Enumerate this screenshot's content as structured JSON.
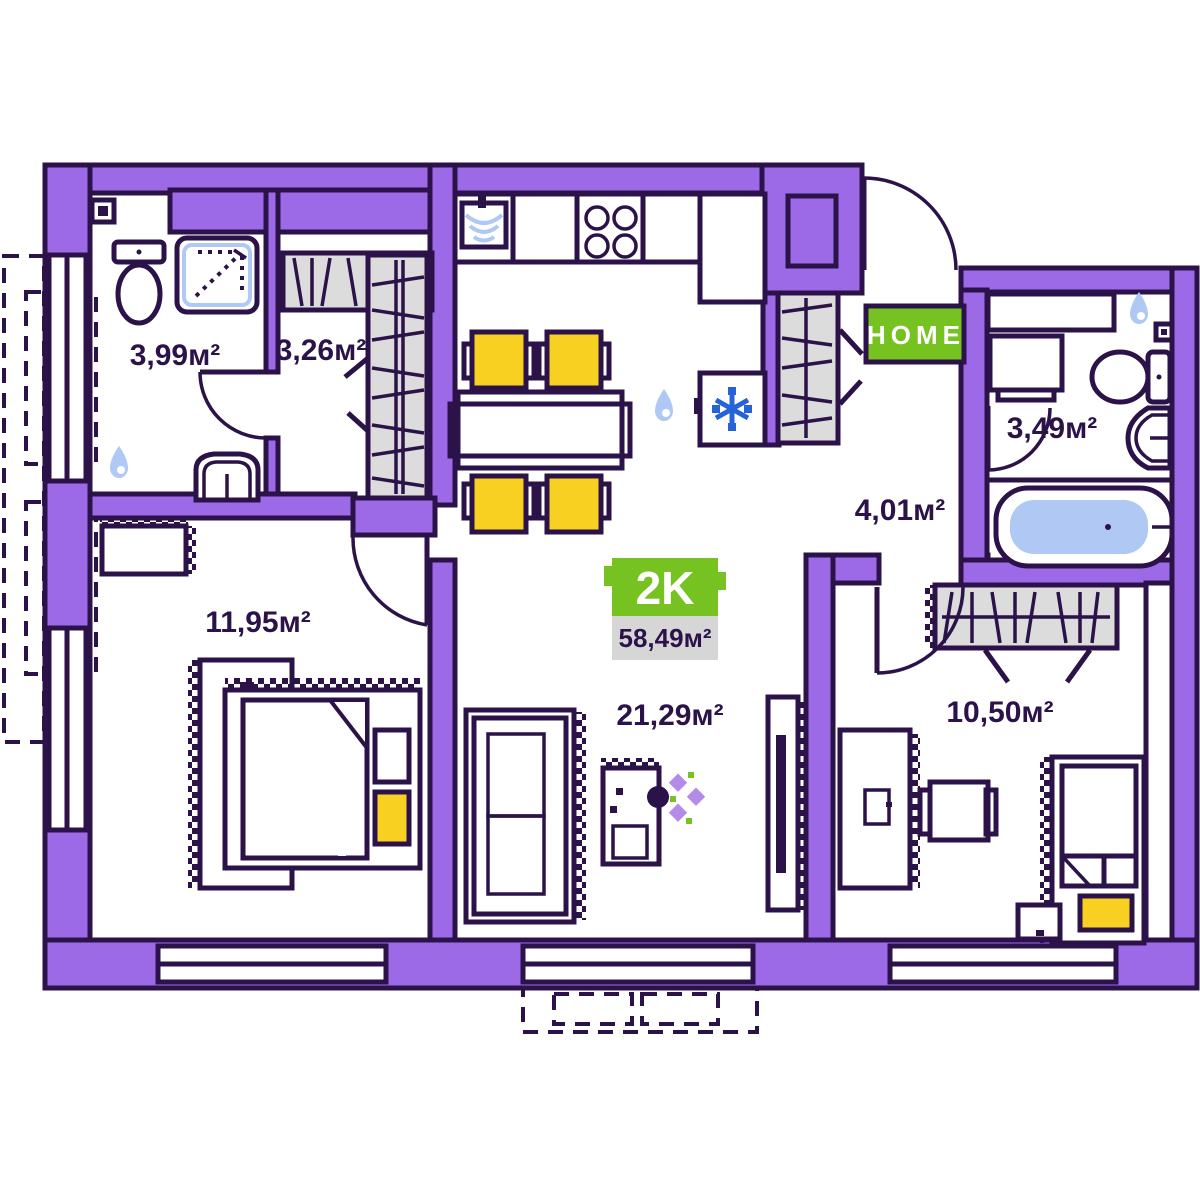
{
  "badge": {
    "type_label": "2K",
    "total_area": "58,49м²"
  },
  "home_sign": {
    "label": "HOME"
  },
  "rooms": {
    "bathroom": {
      "area": "3,99м²"
    },
    "wardrobe": {
      "area": "3,26м²"
    },
    "hallway": {
      "area": "4,01м²"
    },
    "bathroom_2": {
      "area": "3,49м²"
    },
    "bedroom": {
      "area": "11,95м²"
    },
    "living_room": {
      "area": "21,29м²"
    },
    "bedroom_2": {
      "area": "10,50м²"
    }
  },
  "colors": {
    "wall_purple": "#9C69E7",
    "outline_dark": "#2B1248",
    "closet_gray": "#DCDCDC",
    "accent_green": "#76C221",
    "accent_yellow": "#F8D021",
    "water_blue": "#AFC8F4",
    "snowflake_blue": "#2563D6",
    "badge_gray": "#D6D6D6"
  },
  "icons": {
    "water_drop_icon": "💧",
    "snowflake_icon": "❄",
    "flower_icon": "✿",
    "shower_arrow_icon": "↗"
  }
}
